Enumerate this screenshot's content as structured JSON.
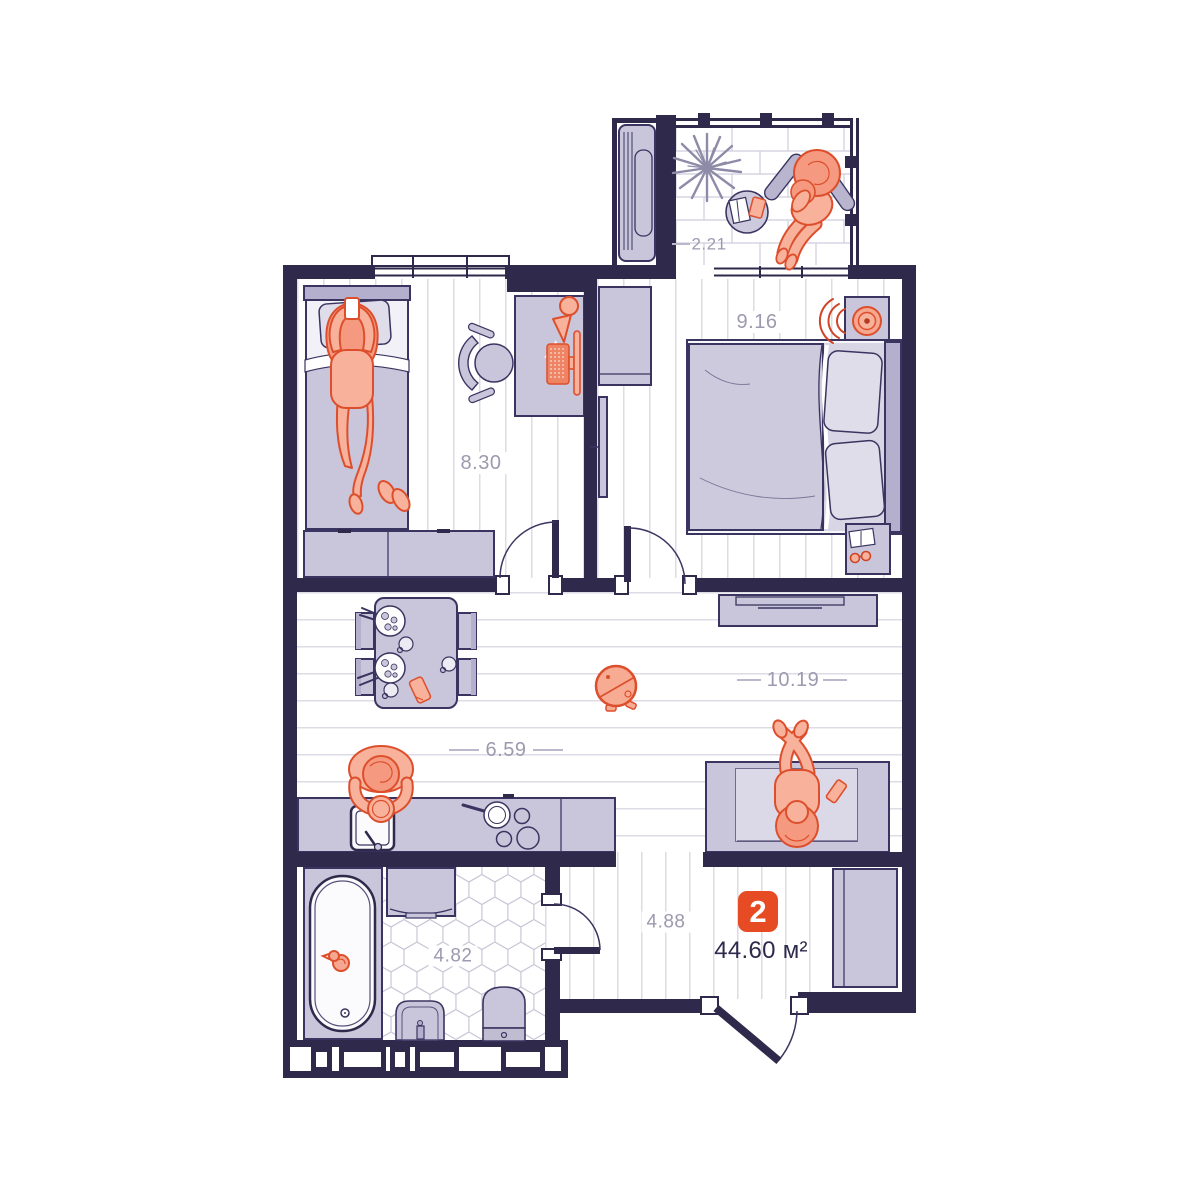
{
  "plan": {
    "unit_number": "2",
    "total_area": "44.60 м²",
    "rooms": [
      {
        "name": "balcony",
        "area": "2.21"
      },
      {
        "name": "bedroom-left",
        "area": "8.30"
      },
      {
        "name": "bedroom-right",
        "area": "9.16"
      },
      {
        "name": "kitchen-dining",
        "area": "6.59"
      },
      {
        "name": "living-area",
        "area": "10.19"
      },
      {
        "name": "hallway",
        "area": "4.88"
      },
      {
        "name": "bathroom",
        "area": "4.82"
      }
    ]
  },
  "colors": {
    "wall": "#2f2a4c",
    "furniture_fill": "#c9c6db",
    "furniture_outline": "#3a3560",
    "accent_fill": "#f8b19b",
    "accent_stroke": "#dd4f2c",
    "badge_background": "#e64b23",
    "badge_text": "#ffffff",
    "room_label_text": "#9c9aae",
    "total_area_text": "#2e2a4d",
    "floor_line": "#dcdbe6"
  }
}
